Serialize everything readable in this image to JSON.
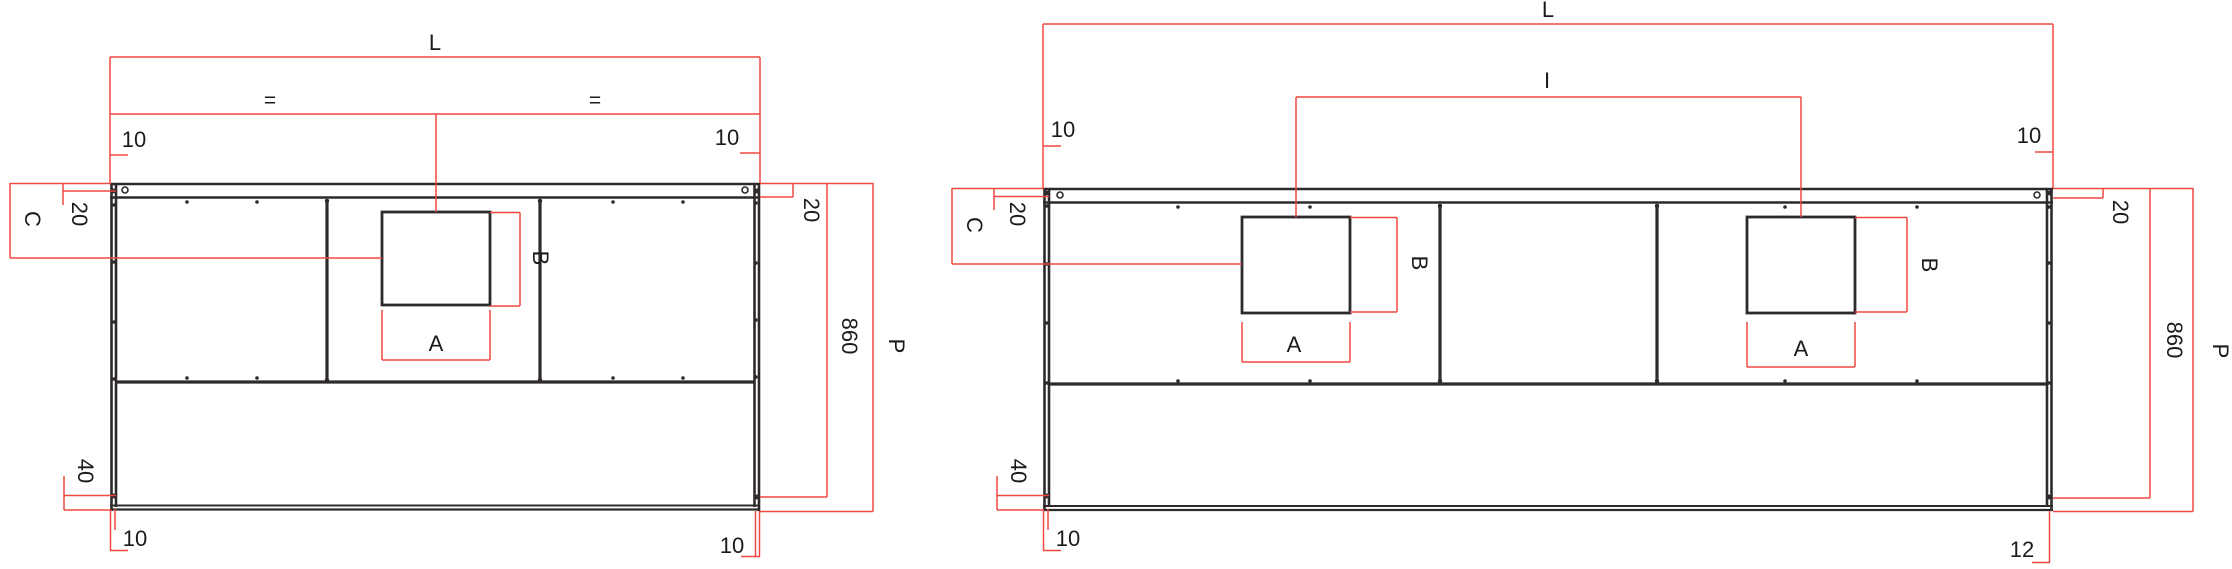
{
  "drawing": {
    "background": "#ffffff",
    "stroke_color": "#2e2a2b",
    "dimension_color": "#ef4840",
    "left_view": {
      "labels": {
        "length": "L",
        "equal_left": "=",
        "equal_right": "=",
        "top_left_offset": "10",
        "top_right_offset": "10",
        "edge_left": "20",
        "side_c": "C",
        "cutout_height": "B",
        "cutout_width": "A",
        "bottom_margin": "40",
        "bottom_left_offset": "10",
        "bottom_right_offset": "10",
        "height": "860",
        "depth": "P",
        "edge_right": "20"
      }
    },
    "right_view": {
      "labels": {
        "length": "L",
        "spacing": "I",
        "top_left_offset": "10",
        "top_right_offset": "10",
        "edge_left": "20",
        "side_c": "C",
        "cutout1_height": "B",
        "cutout1_width": "A",
        "cutout2_height": "B",
        "cutout2_width": "A",
        "bottom_margin": "40",
        "bottom_left_offset": "10",
        "bottom_right_offset": "12",
        "height": "860",
        "depth": "P",
        "edge_right": "20"
      }
    }
  }
}
